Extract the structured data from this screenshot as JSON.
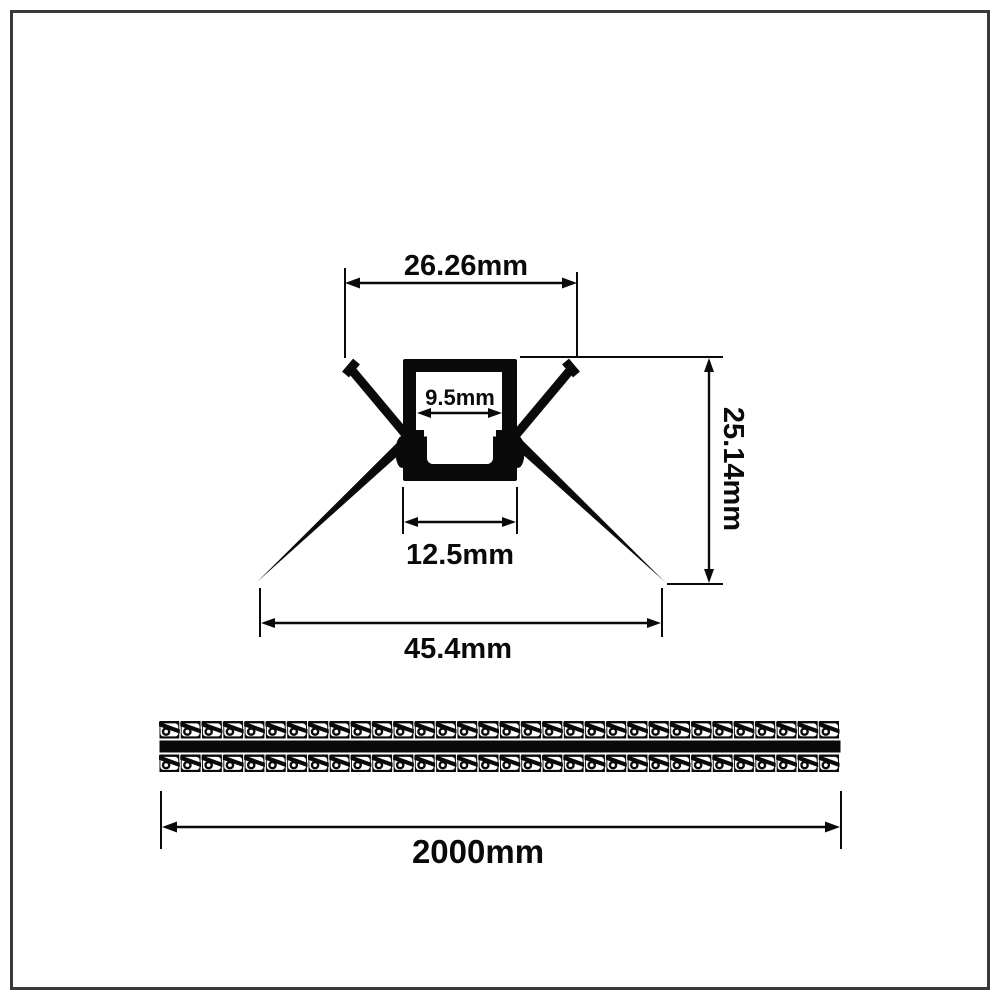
{
  "page": {
    "background": "#ffffff",
    "frame_color": "#3a3a3c",
    "ink_color": "#0a0a0a"
  },
  "cross_section_view": {
    "dims": {
      "top_width": "26.26mm",
      "opening_width": "9.5mm",
      "height": "25.14mm",
      "base_width": "12.5mm",
      "overall_width": "45.4mm"
    }
  },
  "length_view": {
    "length_label": "2000mm",
    "pattern_tiles_per_row": 32,
    "pattern_rows": 2
  }
}
